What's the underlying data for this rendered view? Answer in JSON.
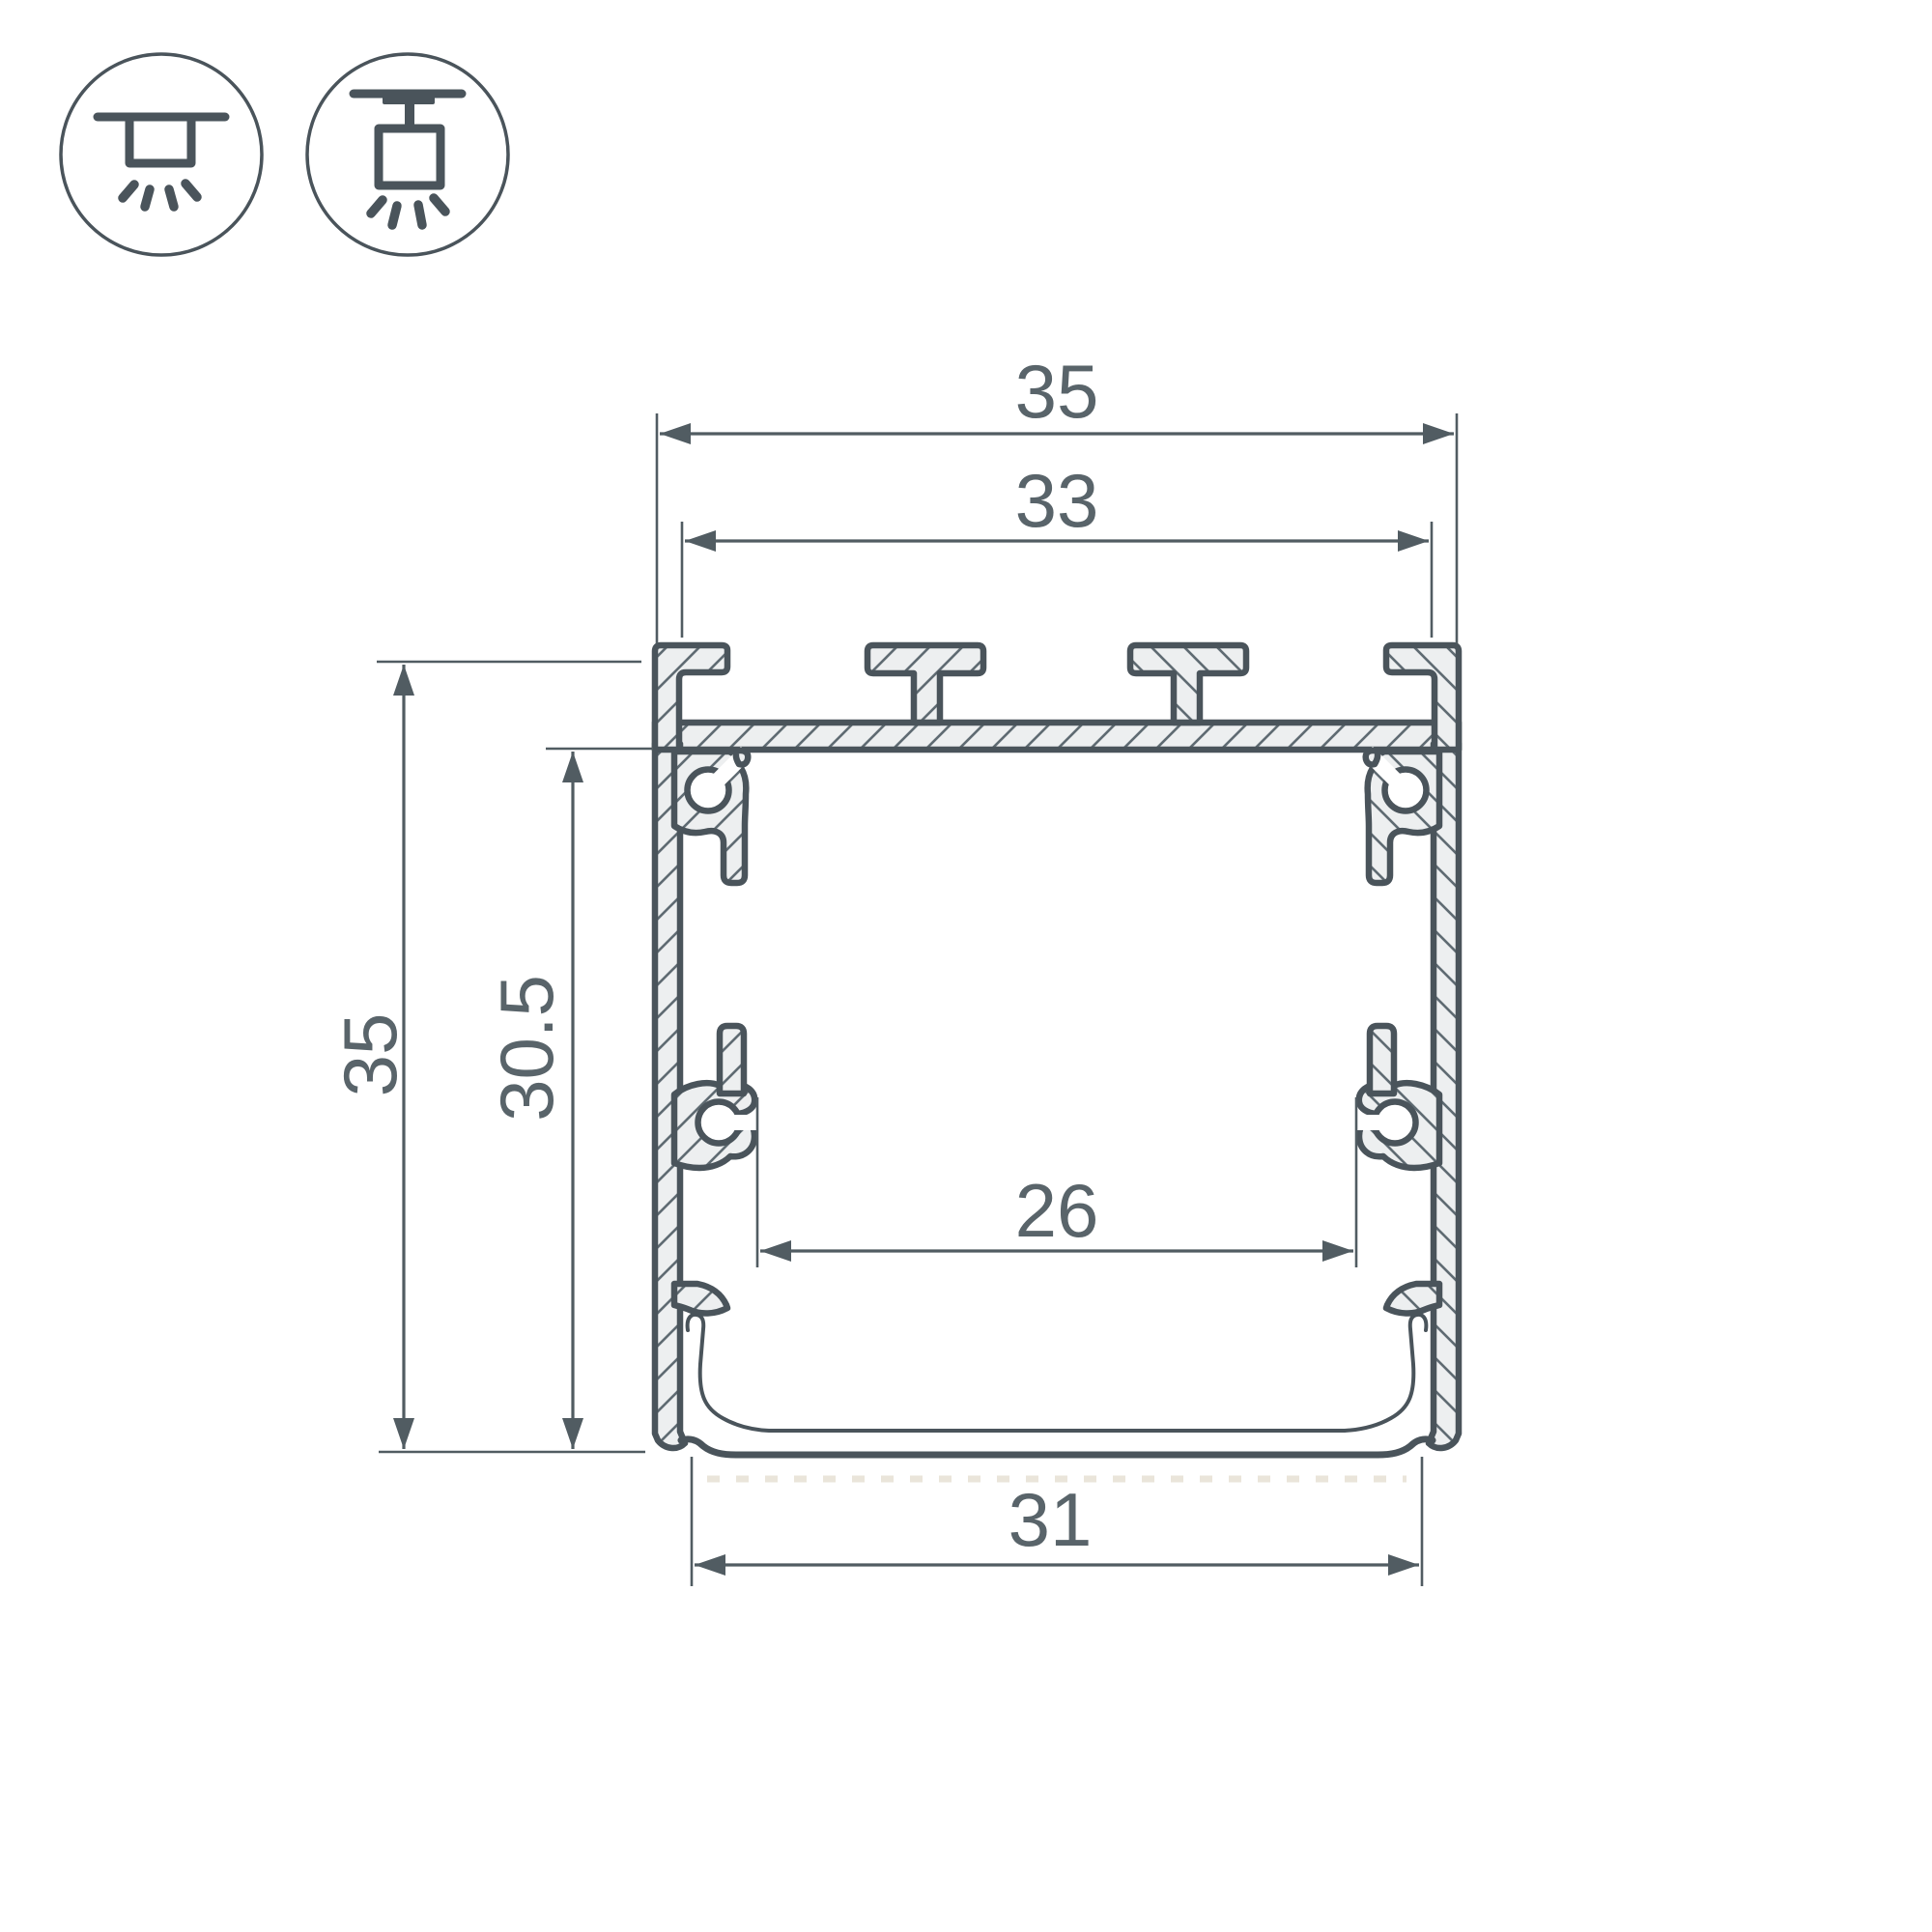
{
  "drawing": {
    "type": "technical-cross-section",
    "subject": "aluminum LED profile cross-section with dimensions"
  },
  "icons": {
    "left": "recessed-ceiling-light-icon",
    "right": "surface-ceiling-light-icon"
  },
  "dims": {
    "width_top": "35",
    "width_inner": "33",
    "height": "35",
    "height_inner": "30.5",
    "width_led_shelf": "26",
    "width_bottom": "31"
  },
  "colors": {
    "background": "#ffffff",
    "outline": "#4a545b",
    "aluminum_fill": "#edeff0",
    "hatch_line": "#5f6b72",
    "dimension": "#515c62",
    "label_text": "#59646a",
    "light_dashed_line": "#eae5da"
  }
}
